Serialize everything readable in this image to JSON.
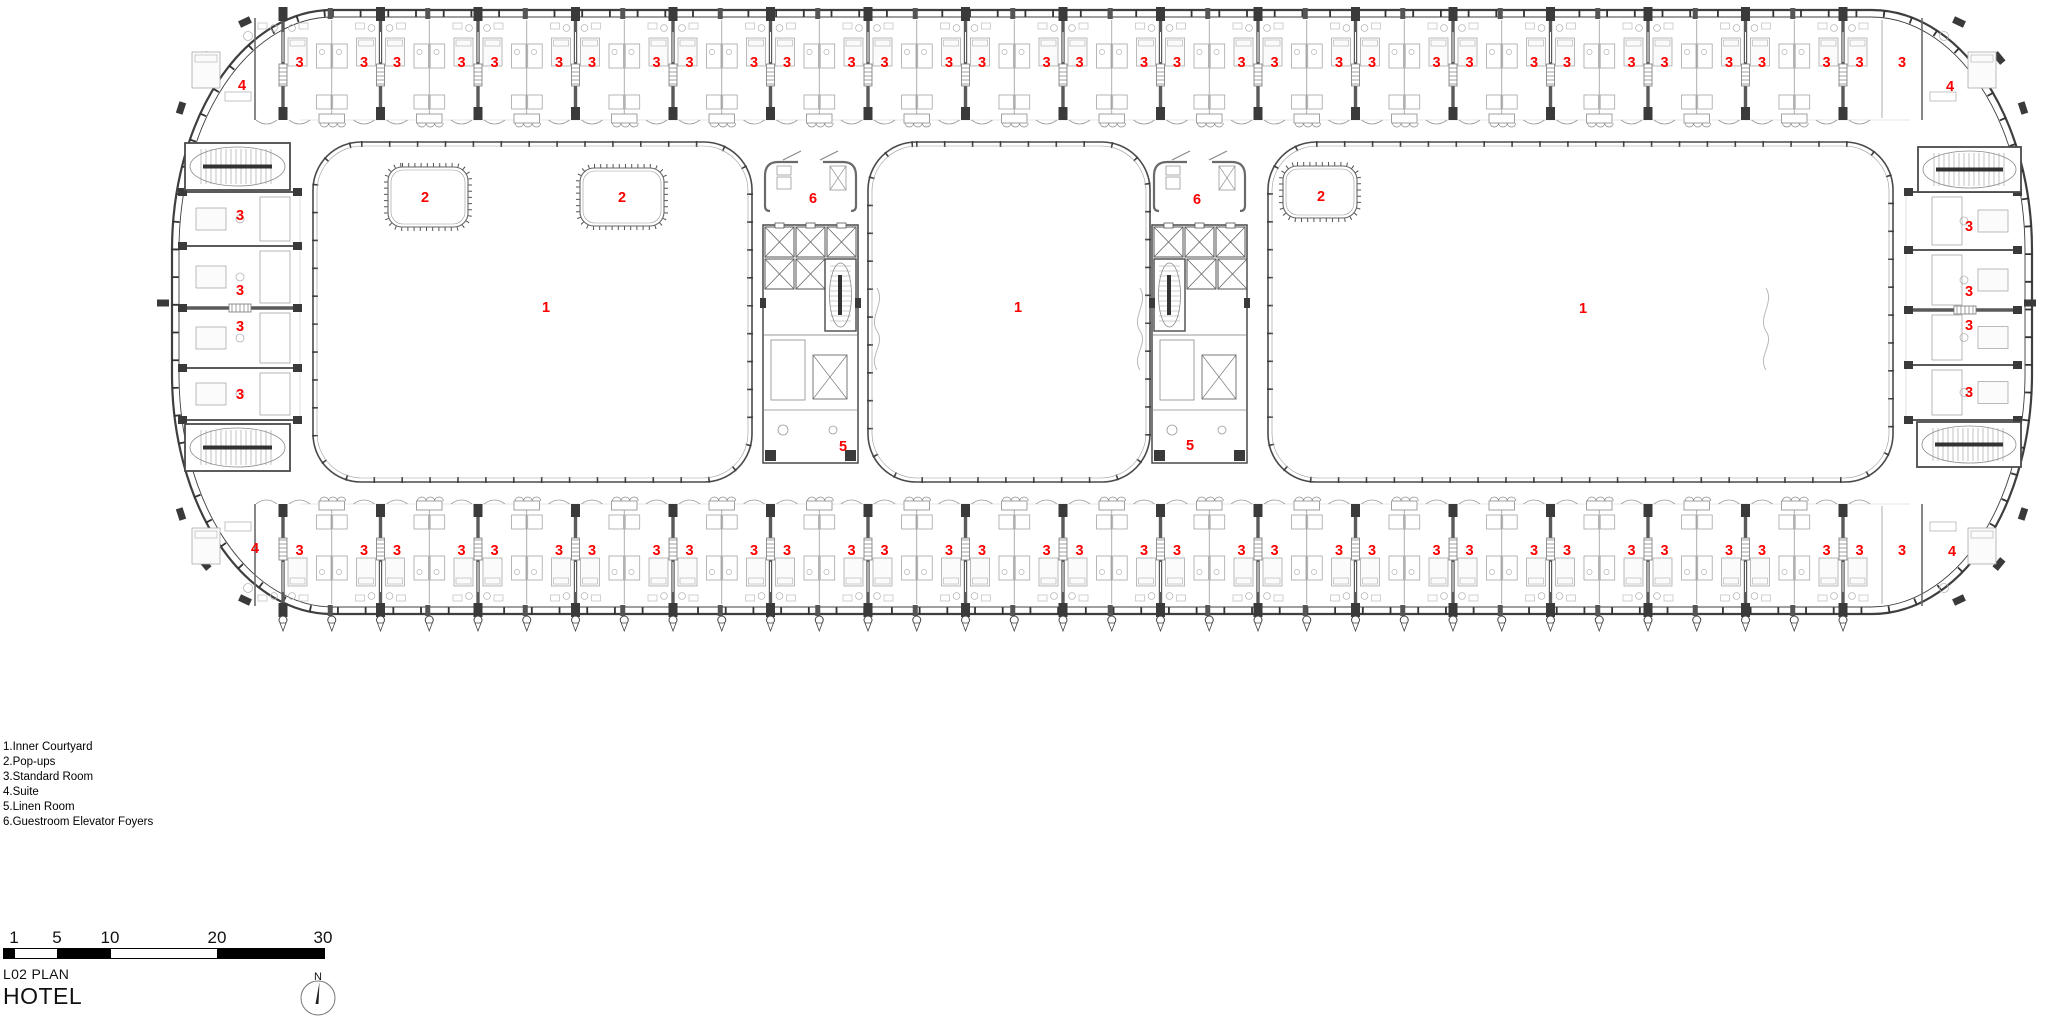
{
  "colors": {
    "red": "#fa0000",
    "ink": "#3f3f3f",
    "wall": "#5a5a5a",
    "mid": "#8a8a8a",
    "faint": "#b9b9b9",
    "dark_fill": "#3a3a3a"
  },
  "legend": {
    "items": [
      "1.Inner Courtyard",
      "2.Pop-ups",
      "3.Standard Room",
      "4.Suite",
      "5.Linen Room",
      "6.Guestroom Elevator Foyers"
    ]
  },
  "title_block": {
    "plan_label": "L02 PLAN",
    "project_label": "HOTEL"
  },
  "scale_bar": {
    "labels": [
      "1",
      "5",
      "10",
      "20",
      "30"
    ]
  },
  "north_arrow": {
    "label": "N"
  },
  "plan": {
    "labels": {
      "courtyard": "1",
      "popup": "2",
      "standard_room": "3",
      "suite": "4",
      "linen_room": "5",
      "elevator_foyer": "6"
    },
    "room_rows": {
      "walls": [
        283,
        380.5,
        478,
        575.5,
        673,
        770.5,
        868,
        965.5,
        1063,
        1160.5,
        1258,
        1355.5,
        1453,
        1550.5,
        1648,
        1745.5,
        1843
      ],
      "label_offset": 16.5,
      "top": {
        "label_y": 63,
        "lead_single_x": 299.5,
        "trail_single_x": 1902,
        "suites": [
          {
            "x": 242,
            "y": 86
          },
          {
            "x": 1950,
            "y": 87
          }
        ]
      },
      "bottom": {
        "label_y": 551,
        "lead_single_x": 299.5,
        "trail_single_x": 1902,
        "suites": [
          {
            "x": 255,
            "y": 549
          },
          {
            "x": 1952,
            "y": 552
          }
        ]
      }
    },
    "end_columns": {
      "left": {
        "label_x": 240,
        "label_ys": [
          216,
          291,
          327,
          395
        ]
      },
      "right": {
        "label_x": 1969,
        "label_ys": [
          227,
          292,
          326,
          393
        ]
      }
    },
    "courtyards": [
      {
        "x": 313,
        "y": 142,
        "w": 439,
        "h": 340,
        "label": {
          "x": 546,
          "y": 308
        }
      },
      {
        "x": 868,
        "y": 142,
        "w": 282,
        "h": 340,
        "label": {
          "x": 1018,
          "y": 308
        }
      },
      {
        "x": 1268,
        "y": 142,
        "w": 625,
        "h": 340,
        "label": {
          "x": 1583,
          "y": 309
        }
      }
    ],
    "popups": [
      {
        "x": 388,
        "y": 167,
        "w": 80,
        "h": 60,
        "label": {
          "x": 425,
          "y": 198
        }
      },
      {
        "x": 580,
        "y": 168,
        "w": 84,
        "h": 58,
        "label": {
          "x": 622,
          "y": 198
        }
      },
      {
        "x": 1283,
        "y": 166,
        "w": 74,
        "h": 52,
        "label": {
          "x": 1321,
          "y": 197
        }
      }
    ],
    "cores": [
      {
        "x": 763,
        "stair": "right",
        "foyer_label": {
          "x": 813,
          "y": 199
        },
        "linen_label": {
          "x": 843,
          "y": 447
        }
      },
      {
        "x": 1152,
        "stair": "left",
        "foyer_label": {
          "x": 1197,
          "y": 200
        },
        "linen_label": {
          "x": 1190,
          "y": 446
        }
      }
    ],
    "stairs": [
      {
        "x": 185,
        "y": 143,
        "w": 105,
        "h": 47
      },
      {
        "x": 185,
        "y": 424,
        "w": 105,
        "h": 47
      },
      {
        "x": 1918,
        "y": 147,
        "w": 103,
        "h": 45
      },
      {
        "x": 1917,
        "y": 422,
        "w": 104,
        "h": 45
      }
    ]
  }
}
